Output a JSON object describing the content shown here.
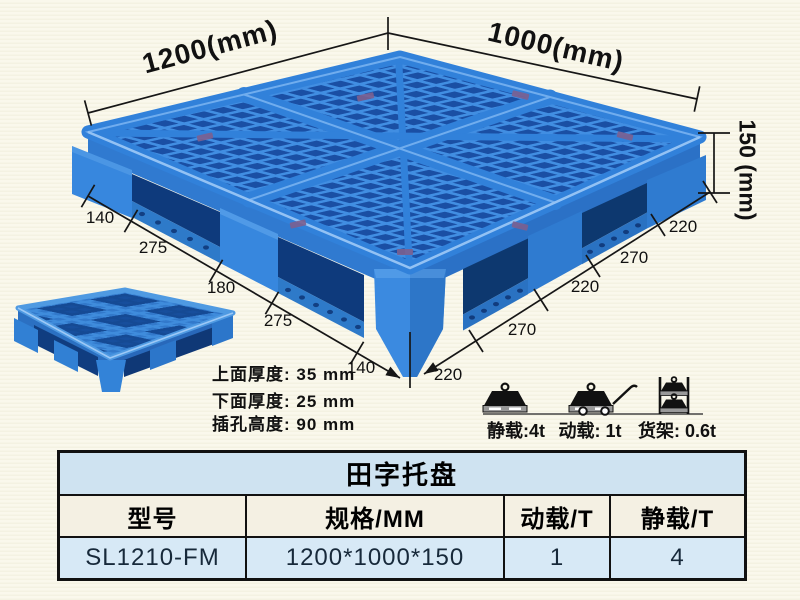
{
  "product": {
    "title": "田字托盘"
  },
  "dimensions": {
    "width_label": "1200(mm)",
    "depth_label": "1000(mm)",
    "height_label": "150 (mm)",
    "left_chain": [
      "140",
      "275",
      "180",
      "275",
      "140"
    ],
    "right_chain": [
      "220",
      "270",
      "220",
      "270",
      "220"
    ]
  },
  "specs": [
    "上面厚度: 35 mm",
    "下面厚度: 25 mm",
    "插孔高度: 90 mm"
  ],
  "loads": {
    "static_label": "静载:4t",
    "dynamic_label": "动载: 1t",
    "rack_label": "货架: 0.6t"
  },
  "table": {
    "title": "田字托盘",
    "headers": [
      "型号",
      "规格/MM",
      "动载/T",
      "静载/T"
    ],
    "rows": [
      [
        "SL1210-FM",
        "1200*1000*150",
        "1",
        "4"
      ]
    ]
  },
  "colors": {
    "pallet_blue": "#3181da",
    "pallet_mesh_hole": "#1a4fa4",
    "pallet_pocket_dark": "#0e3a7c",
    "table_title_bg": "#cfe3f1",
    "table_header_bg": "#f4f0e3",
    "table_data_bg": "#d7e9f6",
    "background_cream": "#faf8ec"
  }
}
